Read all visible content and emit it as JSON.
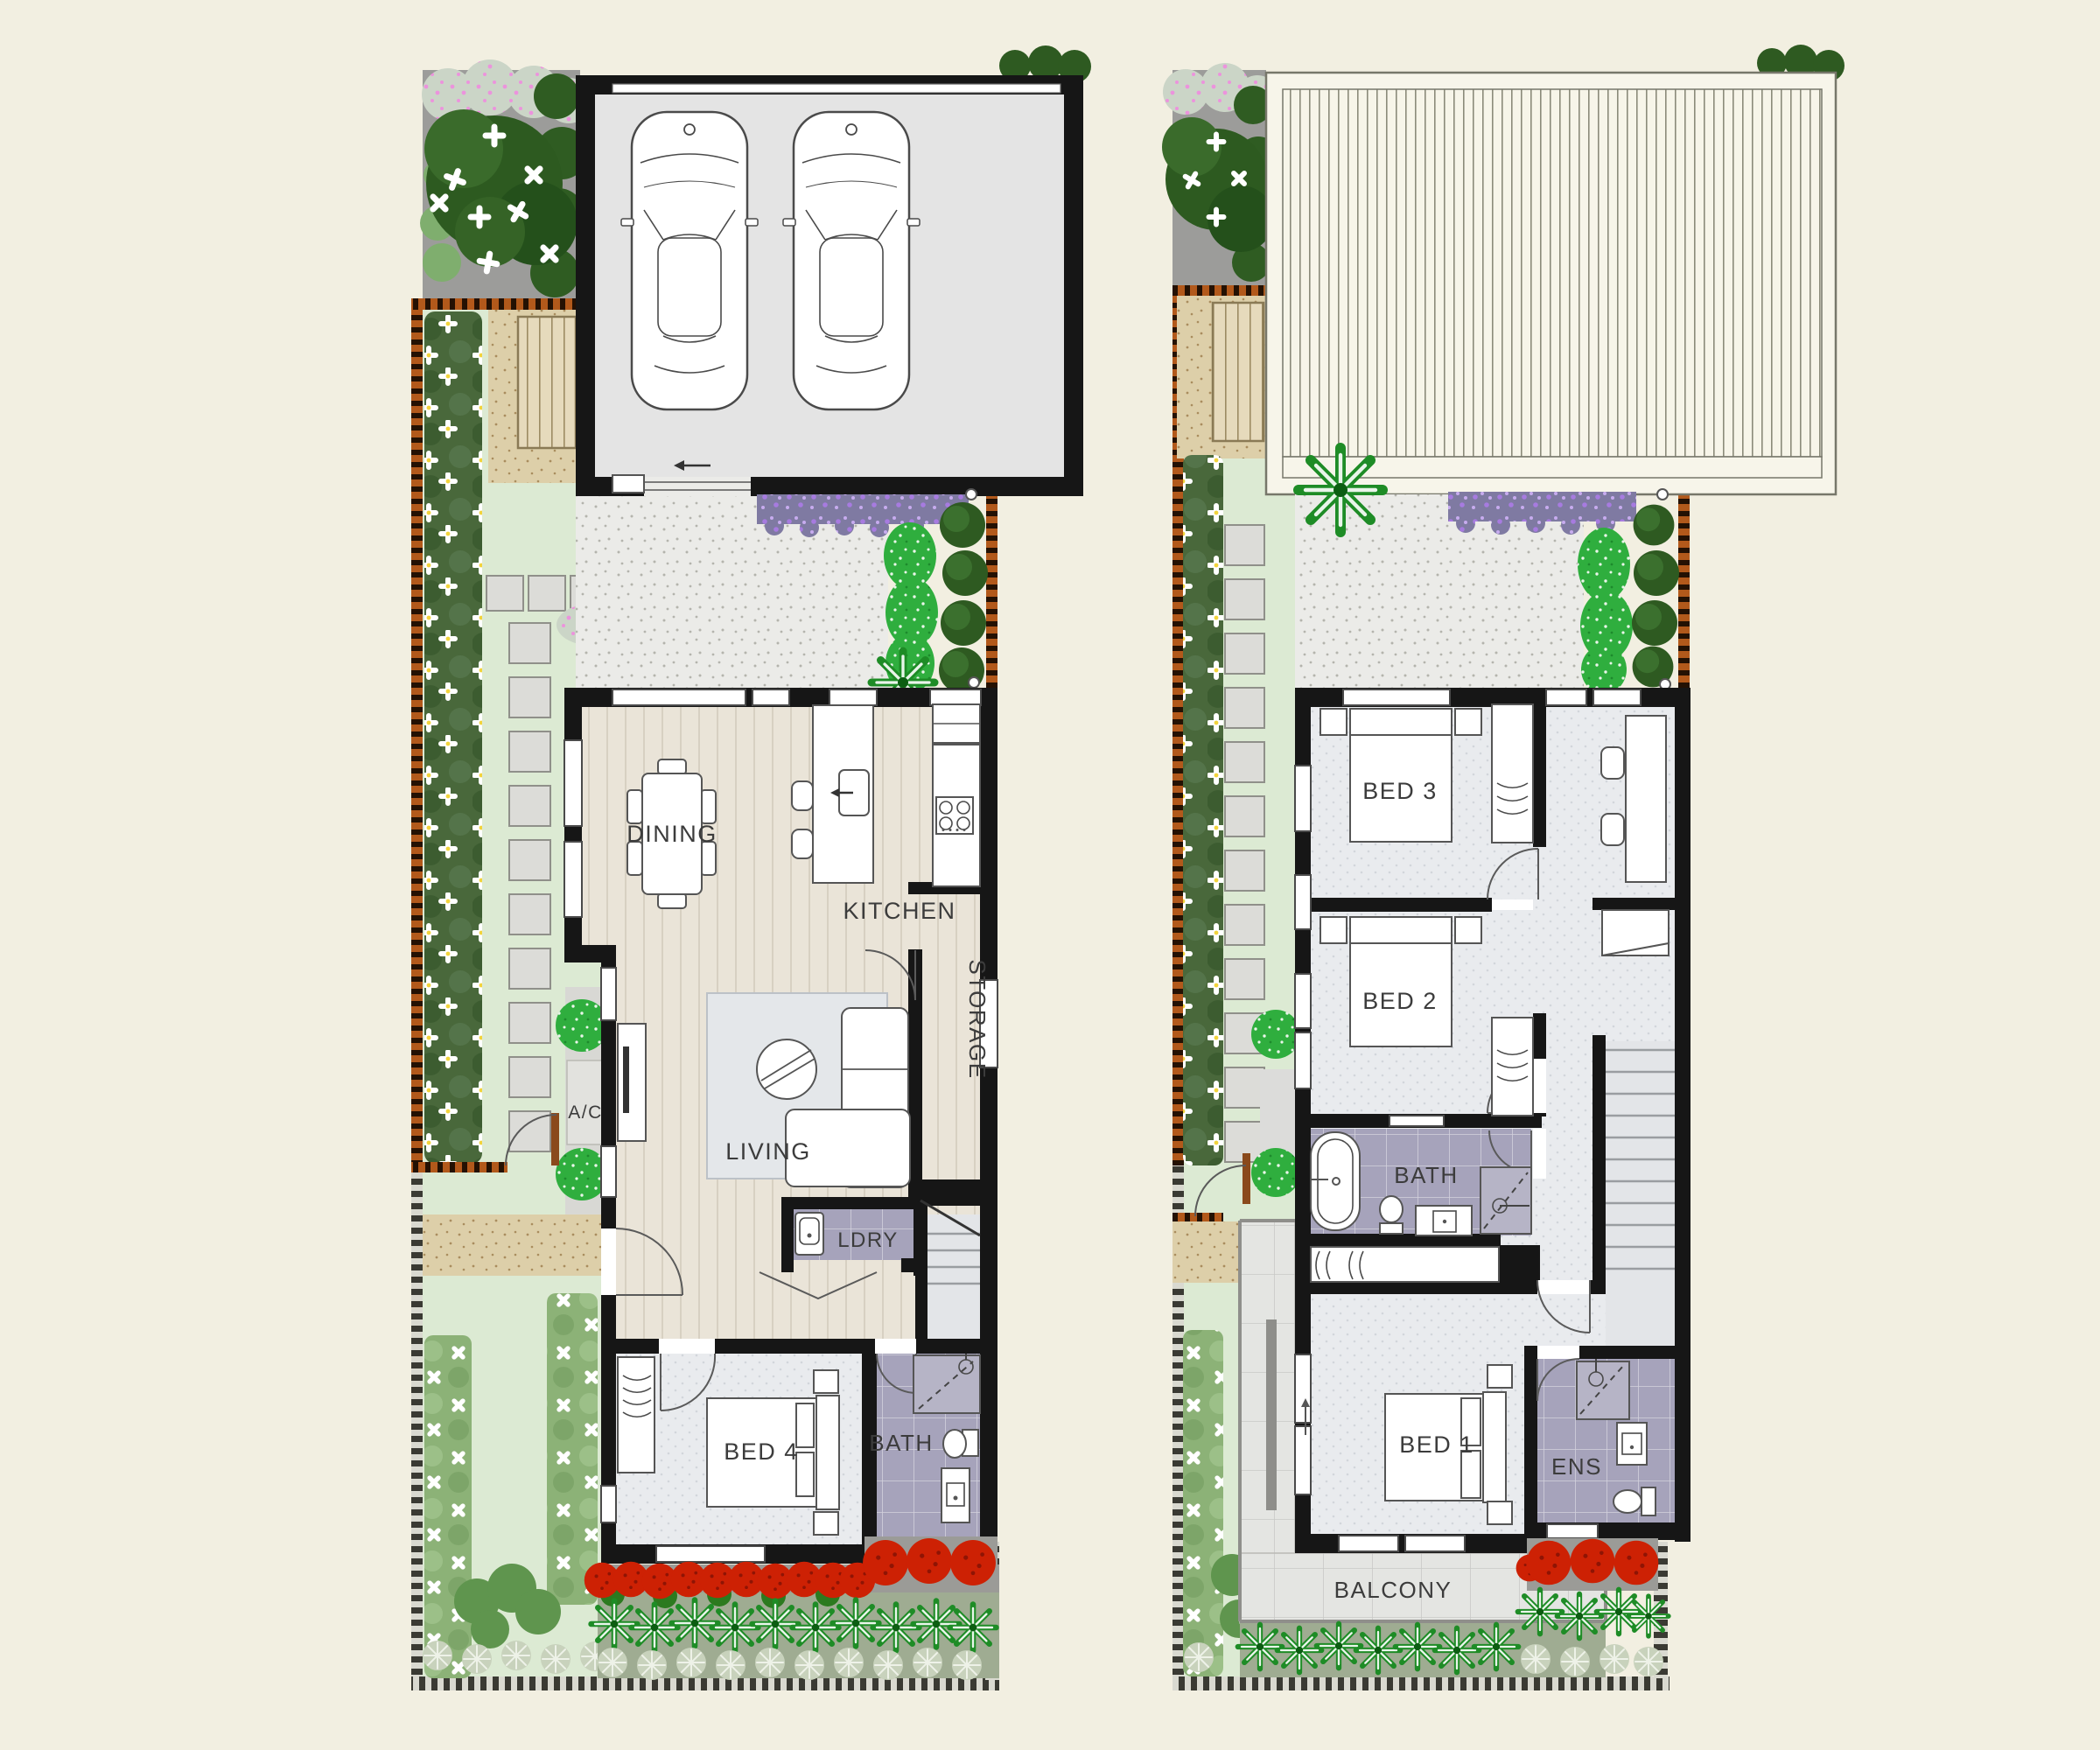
{
  "document": {
    "type": "architectural floor plan",
    "sheets": [
      "ground floor site plan",
      "first floor site plan"
    ]
  },
  "colors": {
    "page_bg": "#f2efe1",
    "wall": "#161616",
    "wood_floor": "#eae4d8",
    "carpet": "#e9ebee",
    "bath_tile": "#a6a3bb",
    "lawn": "#dcead3",
    "hedge_dark": "#49683b",
    "hedge_light": "#8cb277",
    "shrub_bright": "#2fae3e",
    "bush_dark": "#2e5a21",
    "flower_red": "#cd2104",
    "groundcover_purple": "#7f7aa2",
    "fence_timber": "#b2591b",
    "deck_timber": "#e6dabc",
    "concrete": "#ebebe8",
    "sand_path": "#ddcfa9",
    "roof": "#f7f5e9",
    "balcony_tile": "#e4e5e2",
    "garage_floor": "#e4e4e4"
  },
  "ground_floor": {
    "rooms": {
      "dining": "DINING",
      "kitchen": "KITCHEN",
      "storage": "STORAGE",
      "living": "LIVING",
      "laundry": "LDRY",
      "ac": "A/C",
      "bed4": "BED 4",
      "bath": "BATH"
    }
  },
  "first_floor": {
    "rooms": {
      "bed3": "BED 3",
      "bed2": "BED 2",
      "bath": "BATH",
      "bed1": "BED 1",
      "ensuite": "ENS",
      "balcony": "BALCONY"
    }
  }
}
